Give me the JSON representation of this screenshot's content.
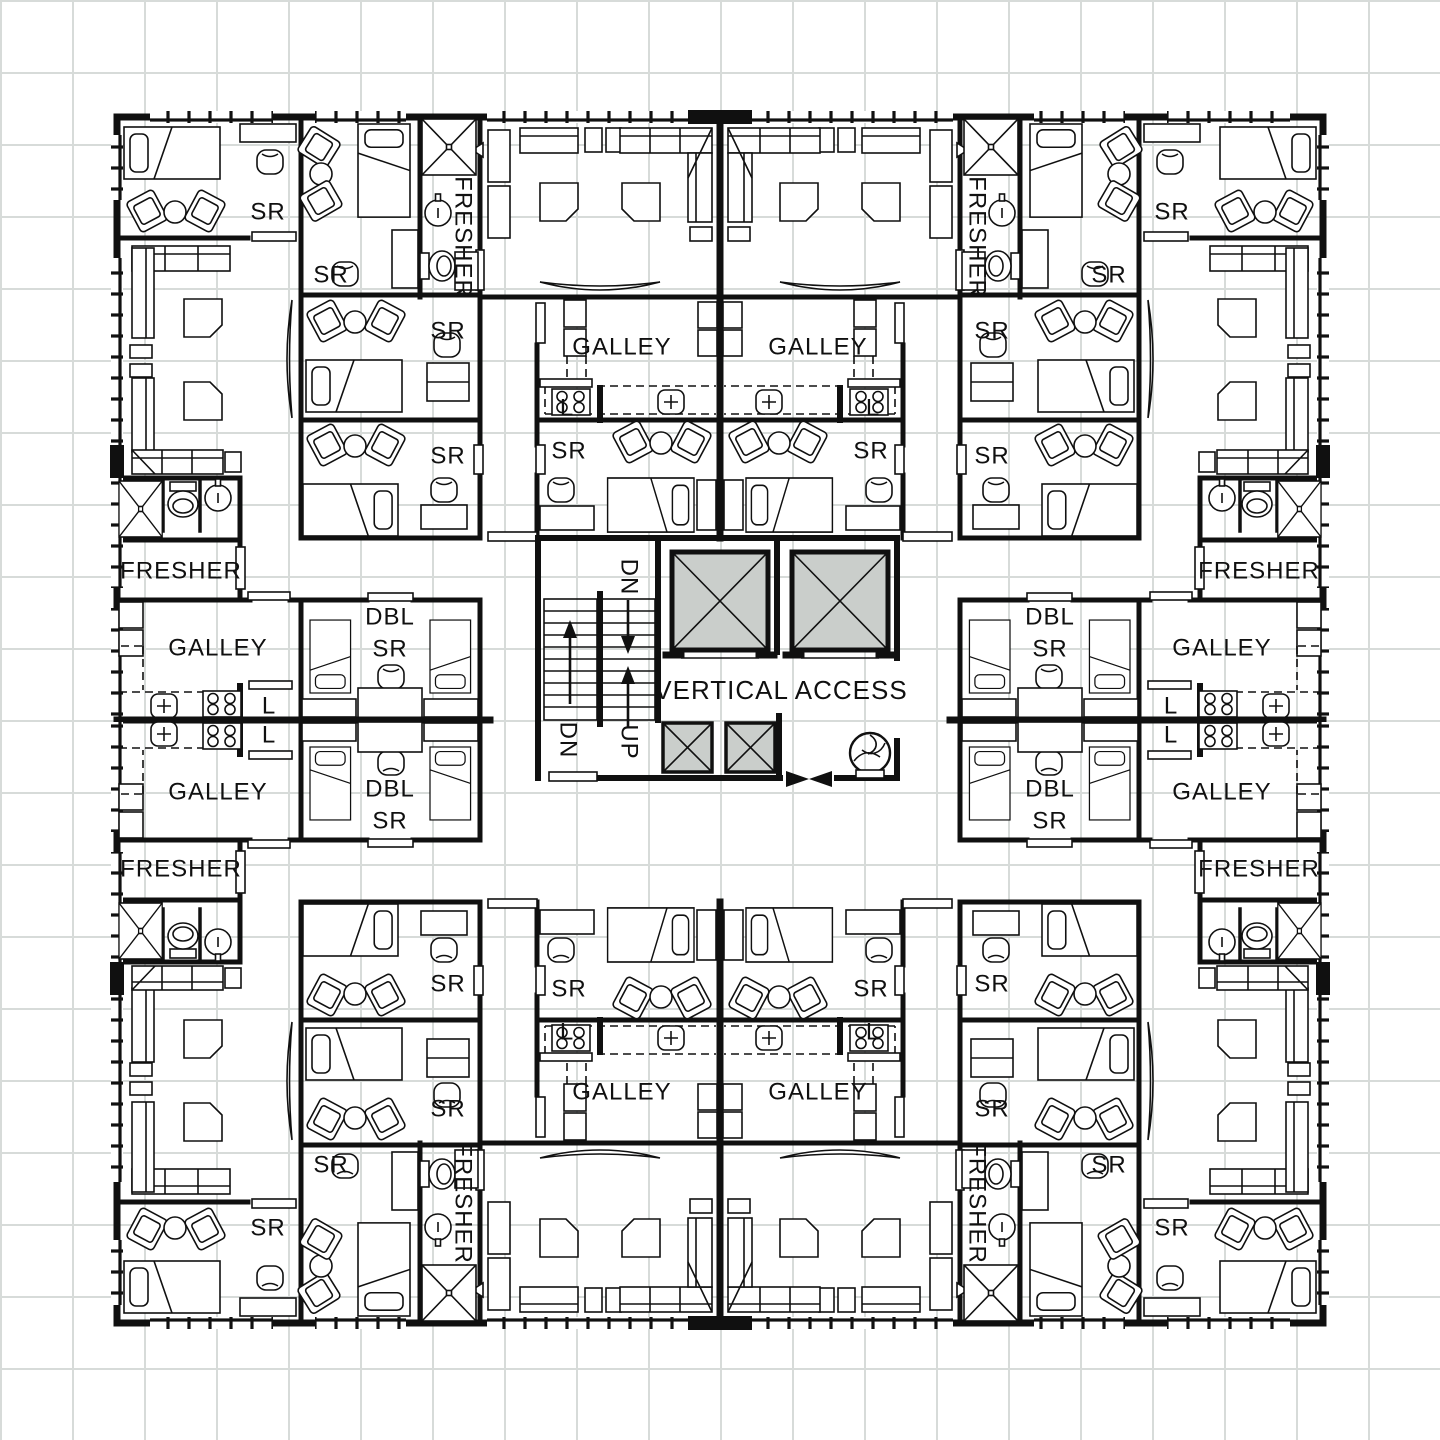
{
  "title": "Residential tower floor plan",
  "colors": {
    "wall": "#101010",
    "grid": "#d7dbd9",
    "shaft": "#cacecb",
    "paper": "#ffffff"
  },
  "plan": {
    "core_label": "VERTICAL ACCESS",
    "room_types": [
      "SR",
      "DBL SR",
      "GALLEY",
      "FRESHER",
      "L"
    ],
    "stair_labels": [
      "DN",
      "UP"
    ],
    "labels": [
      {
        "text": "SR",
        "x": 268,
        "y": 212
      },
      {
        "text": "SR",
        "x": 1172,
        "y": 212
      },
      {
        "text": "SR",
        "x": 268,
        "y": 1228
      },
      {
        "text": "SR",
        "x": 1172,
        "y": 1228
      },
      {
        "text": "SR",
        "x": 331,
        "y": 275
      },
      {
        "text": "SR",
        "x": 1109,
        "y": 275
      },
      {
        "text": "SR",
        "x": 331,
        "y": 1165
      },
      {
        "text": "SR",
        "x": 1109,
        "y": 1165
      },
      {
        "text": "SR",
        "x": 448,
        "y": 331
      },
      {
        "text": "SR",
        "x": 992,
        "y": 331
      },
      {
        "text": "SR",
        "x": 448,
        "y": 1109
      },
      {
        "text": "SR",
        "x": 992,
        "y": 1109
      },
      {
        "text": "SR",
        "x": 448,
        "y": 456
      },
      {
        "text": "SR",
        "x": 992,
        "y": 456
      },
      {
        "text": "SR",
        "x": 448,
        "y": 984
      },
      {
        "text": "SR",
        "x": 992,
        "y": 984
      },
      {
        "text": "SR",
        "x": 569,
        "y": 451
      },
      {
        "text": "SR",
        "x": 871,
        "y": 451
      },
      {
        "text": "SR",
        "x": 569,
        "y": 989
      },
      {
        "text": "SR",
        "x": 871,
        "y": 989
      },
      {
        "text": "GALLEY",
        "x": 622,
        "y": 347
      },
      {
        "text": "GALLEY",
        "x": 818,
        "y": 347
      },
      {
        "text": "GALLEY",
        "x": 218,
        "y": 648
      },
      {
        "text": "GALLEY",
        "x": 1222,
        "y": 648
      },
      {
        "text": "GALLEY",
        "x": 218,
        "y": 792
      },
      {
        "text": "GALLEY",
        "x": 1222,
        "y": 792
      },
      {
        "text": "GALLEY",
        "x": 622,
        "y": 1092
      },
      {
        "text": "GALLEY",
        "x": 818,
        "y": 1092
      },
      {
        "text": "FRESHER",
        "x": 181,
        "y": 571
      },
      {
        "text": "FRESHER",
        "x": 1259,
        "y": 571
      },
      {
        "text": "FRESHER",
        "x": 181,
        "y": 869
      },
      {
        "text": "FRESHER",
        "x": 1259,
        "y": 869
      },
      {
        "text": "FRESHER",
        "x": 463,
        "y": 237,
        "rot": 90
      },
      {
        "text": "FRESHER",
        "x": 977,
        "y": 237,
        "rot": 90
      },
      {
        "text": "FRESHER",
        "x": 463,
        "y": 1203,
        "rot": 90
      },
      {
        "text": "FRESHER",
        "x": 977,
        "y": 1203,
        "rot": 90
      },
      {
        "text": "DBL",
        "x": 390,
        "y": 617
      },
      {
        "text": "SR",
        "x": 390,
        "y": 649
      },
      {
        "text": "DBL",
        "x": 1050,
        "y": 617
      },
      {
        "text": "SR",
        "x": 1050,
        "y": 649
      },
      {
        "text": "DBL",
        "x": 390,
        "y": 789
      },
      {
        "text": "SR",
        "x": 390,
        "y": 821
      },
      {
        "text": "DBL",
        "x": 1050,
        "y": 789
      },
      {
        "text": "SR",
        "x": 1050,
        "y": 821
      },
      {
        "text": "L",
        "x": 567,
        "y": 408
      },
      {
        "text": "L",
        "x": 873,
        "y": 408
      },
      {
        "text": "L",
        "x": 567,
        "y": 1032
      },
      {
        "text": "L",
        "x": 873,
        "y": 1032
      },
      {
        "text": "L",
        "x": 269,
        "y": 706
      },
      {
        "text": "L",
        "x": 269,
        "y": 735
      },
      {
        "text": "L",
        "x": 1171,
        "y": 706
      },
      {
        "text": "L",
        "x": 1171,
        "y": 735
      },
      {
        "text": "DN",
        "x": 629,
        "y": 577,
        "rot": 90
      },
      {
        "text": "DN",
        "x": 568,
        "y": 740,
        "rot": 90
      },
      {
        "text": "UP",
        "x": 629,
        "y": 742,
        "rot": 90
      },
      {
        "text": "VERTICAL ACCESS",
        "x": 781,
        "y": 690,
        "size": 26
      }
    ]
  }
}
